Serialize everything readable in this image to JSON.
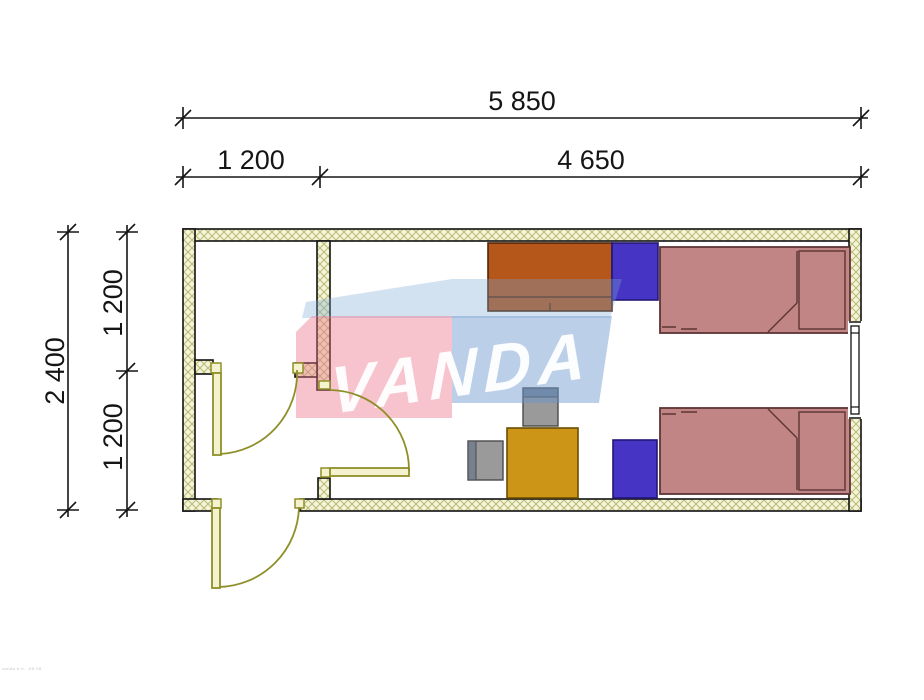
{
  "dimensions": {
    "total_width": "5 850",
    "segment_left": "1 200",
    "segment_right": "4 650",
    "total_height": "2 400",
    "height_upper": "1 200",
    "height_lower": "1 200"
  },
  "watermark": {
    "text": "VANDA",
    "pink_band_color": "#f2aab6",
    "blue_band_color": "#b4cde9"
  },
  "plan_colors": {
    "wall_fill": "#f4f4d6",
    "wall_hatch": "#b9b97a",
    "wall_edge": "#111111",
    "door_line": "#8f8f2a",
    "bed_fill": "#c18585",
    "bed_outline": "#5d3434",
    "wardrobe_fill": "#4634c4",
    "cabinet_fill": "#b5561b",
    "desk_fill": "#cd9517",
    "chair_fill": "#9a9a9a"
  },
  "footer_note": "vanda b.b. -05 08"
}
